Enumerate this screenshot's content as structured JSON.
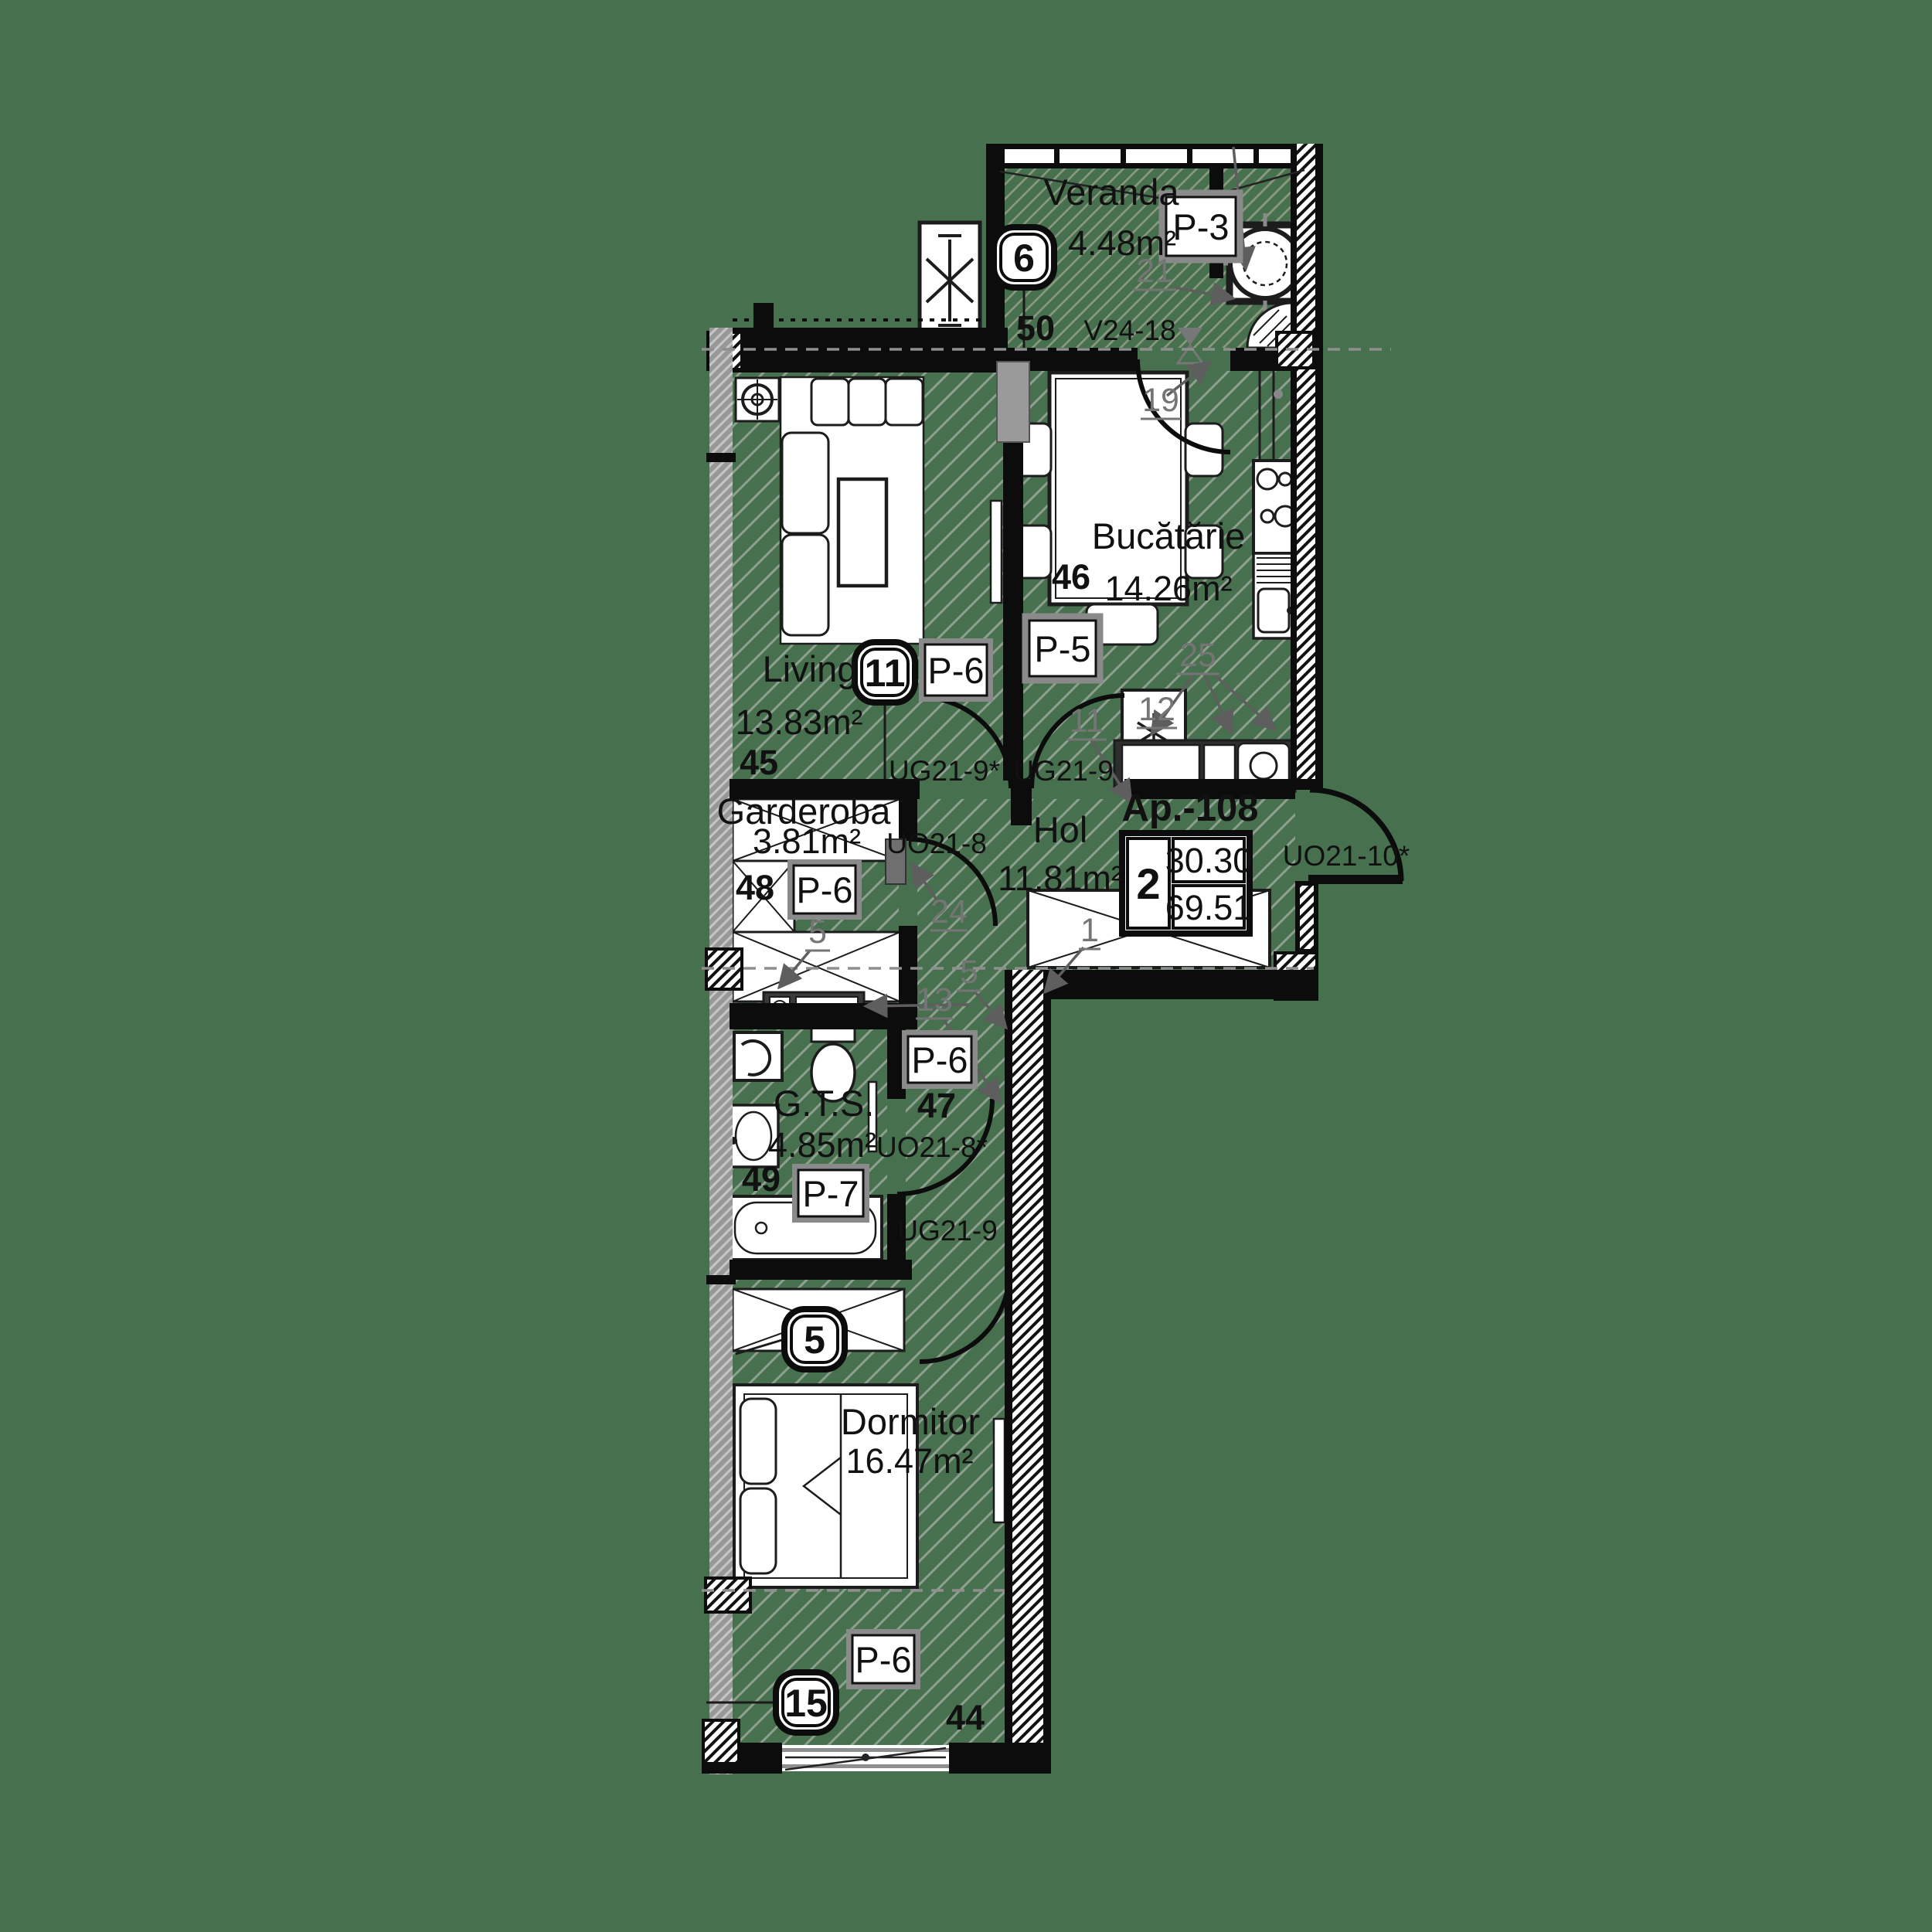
{
  "apartment": {
    "label": "Ap.-108",
    "rooms_count": "2",
    "living_area": "30.30",
    "total_area": "69.51"
  },
  "rooms": {
    "veranda": {
      "name": "Veranda",
      "area": "4.48m²",
      "zone": "50",
      "badge": "6",
      "panel": "P-3",
      "window_code": "V24-18"
    },
    "bucatarie": {
      "name": "Bucătărie",
      "area": "14.26m²",
      "zone": "46",
      "panel": "P-5"
    },
    "living": {
      "name": "Living",
      "area": "13.83m²",
      "zone": "45",
      "badge": "11",
      "panel": "P-6"
    },
    "garderoba": {
      "name": "Garderoba",
      "area": "3.81m²",
      "zone": "48",
      "panel": "P-6",
      "door_code": "UO21-8"
    },
    "hol": {
      "name": "Hol",
      "area": "11.81m²",
      "entry_door_code": "UO21-10*"
    },
    "gts": {
      "name": "G.T.S.",
      "area": "4.85m²",
      "zone": "49",
      "panel": "P-7",
      "door_code": "UO21-8*"
    },
    "corridor": {
      "zone": "47",
      "panel": "P-6",
      "door_code": "UG21-9"
    },
    "dormitor": {
      "name": "Dormitor",
      "area": "16.47m²",
      "zone": "44",
      "badge": "5",
      "panel": "P-6",
      "window_badge": "15"
    }
  },
  "door_codes": {
    "living_hol": "UG21-9*",
    "kitchen_hol": "UG21-9"
  },
  "annotations": {
    "hol_wardrobe": "1",
    "garderoba_cabinet": "5",
    "corridor_wall": "5",
    "kitchen_counter": "11",
    "fridge": "12",
    "vent_unit": "13",
    "kitchen_entry": "19",
    "boiler": "21",
    "garderoba_door": "24",
    "counter_items": "25"
  },
  "colors": {
    "background": "#47704e",
    "walls": "#0c0c0c",
    "floor_hatch": "#8da08f",
    "annotation_gray": "#757575",
    "furniture_fill": "#ffffff"
  }
}
